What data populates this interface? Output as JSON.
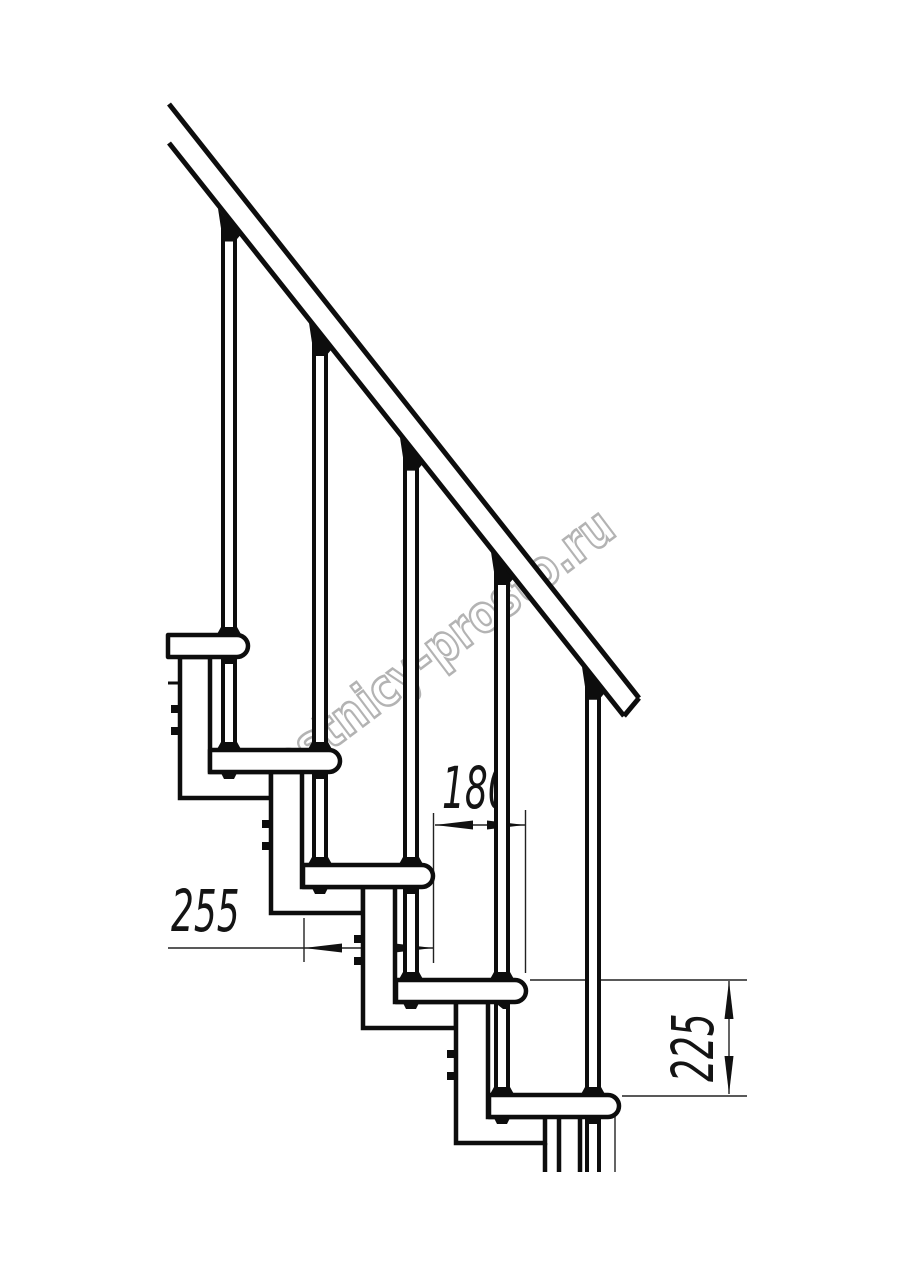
{
  "drawing": {
    "type": "staircase-fragment-side-view",
    "watermark": {
      "text": "lestnicy-prosto.ru",
      "color": "#b3b3b3"
    },
    "dimensions": {
      "tread_depth": {
        "value": "255",
        "meaning": "tread depth, mm"
      },
      "step_run": {
        "value": "180",
        "meaning": "horizontal step run, mm"
      },
      "riser_height": {
        "value": "225",
        "meaning": "riser height between treads, mm"
      }
    },
    "colors": {
      "line": "#0d0d0d",
      "thin_line": "#222222",
      "background": "#ffffff"
    }
  }
}
